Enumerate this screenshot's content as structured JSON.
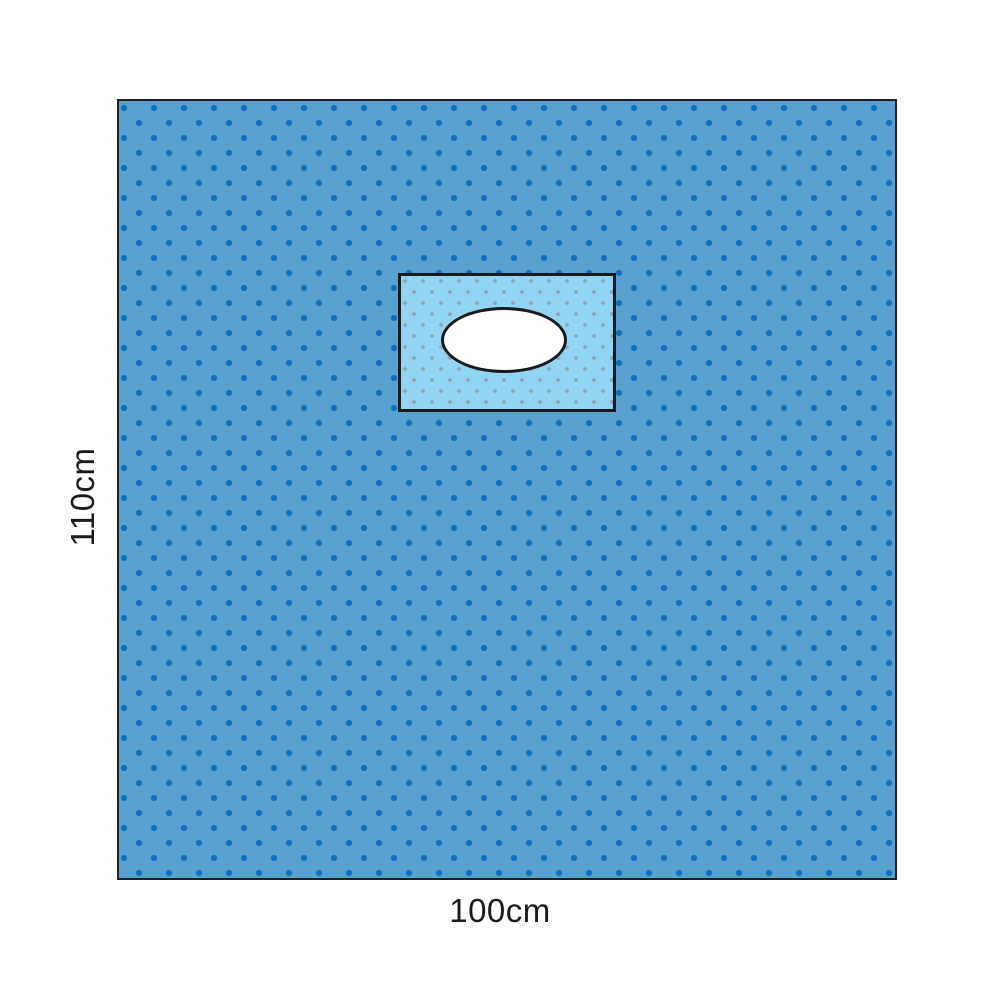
{
  "diagram": {
    "height_label": "110cm",
    "width_label": "100cm"
  },
  "icons": {
    "fenestration_hole": "white-oval-cutout"
  },
  "colors": {
    "background": "#ffffff",
    "drape_fill": "#58a1ce",
    "drape_dot": "#0c70be",
    "drape_outline": "#212121",
    "patch_fill": "#92d4f3",
    "patch_dot": "#8fa3b0",
    "patch_outline": "#1a1a1a",
    "fenestration_fill": "#ffffff",
    "fenestration_outline": "#1a1a1a"
  }
}
